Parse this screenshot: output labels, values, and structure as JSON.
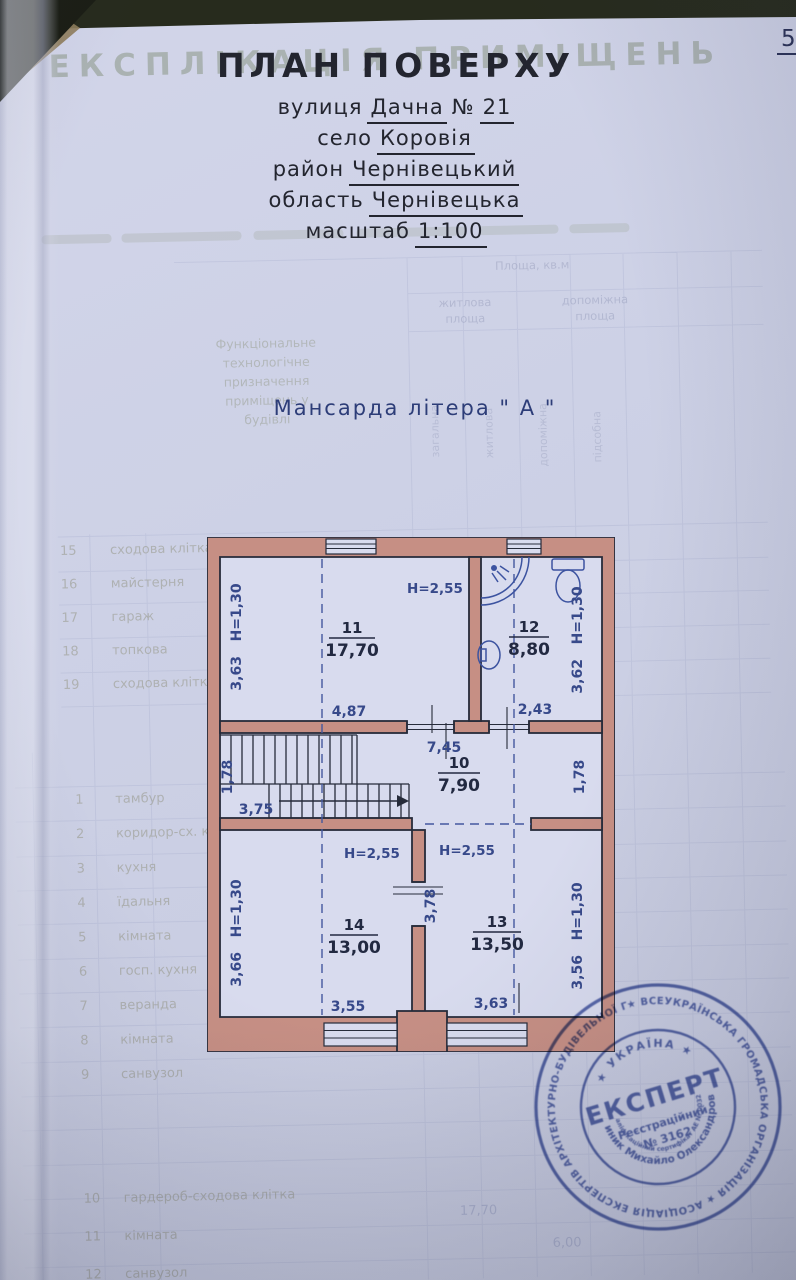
{
  "page": {
    "number": "5"
  },
  "header": {
    "ghost_title": "ЕКСПЛІКАЦІЯ ПРИМІЩЕНЬ",
    "title": "ПЛАН ПОВЕРХУ",
    "address": [
      {
        "label": "вулиця",
        "value": "Дачна",
        "mid": "№",
        "value2": "21"
      },
      {
        "label": "село",
        "value": "Коровія"
      },
      {
        "label": "район",
        "value": "Чернівецький"
      },
      {
        "label": "область",
        "value": "Чернівецька"
      },
      {
        "label": "масштаб",
        "value": "1:100"
      }
    ],
    "subtitle": "Мансарда літера \" А \""
  },
  "plan": {
    "rooms": {
      "r11": {
        "number": "11",
        "area": "17,70",
        "ceiling": "H=2,55",
        "side": "3,63   H=1,30",
        "width": "4,87"
      },
      "r12": {
        "number": "12",
        "area": "8,80",
        "side": "3,62   H=1,30",
        "width": "2,43"
      },
      "r10": {
        "number": "10",
        "area": "7,90",
        "width_top": "7,45",
        "left": "1,78",
        "right": "1,78",
        "stairs": "3,75"
      },
      "r14": {
        "number": "14",
        "area": "13,00",
        "ceiling": "H=2,55",
        "side": "3,66   H=1,30",
        "width": "3,55"
      },
      "r13": {
        "number": "13",
        "area": "13,50",
        "ceiling": "H=2,55",
        "partition": "3,78",
        "side": "3,56   H=1,30",
        "width": "3,63"
      }
    }
  },
  "stamp": {
    "outer_ring": "★ ВСЕУКРАЇНСЬКА ГРОМАДСЬКА ОРГАНІЗАЦІЯ ★ АСОЦІАЦІЯ ЕКСПЕРТІВ АРХІТЕКТУРНО-БУДІВЕЛЬНОЇ ГАЛУЗІ ★ АТЕСТАЦІЙНА КОМІСІЯ",
    "inner_top": "★ УКРАЇНА ★",
    "inner_name": "Гриник Михайло Олександрович",
    "inner_cert": "кваліфікаційний сертифікат АЕ № 003289",
    "name": "ЕКСПЕРТ",
    "reg_label": "Реєстраційний",
    "reg_number": "№ 3162"
  },
  "ghost": {
    "area_header": "Площа, кв.м",
    "col_headers": [
      [
        "житлова",
        "площа"
      ],
      [
        "допоміжна",
        "площа"
      ]
    ],
    "rot_labels": [
      "загальна",
      "житлова",
      "допоміжна",
      "підсобна"
    ],
    "function_lines": [
      "Функціональне",
      "технологічне",
      "призначення",
      "приміщень у",
      "будівлі"
    ],
    "mid_rows": [
      [
        "15",
        "сходова клітка"
      ],
      [
        "16",
        "майстерня"
      ],
      [
        "17",
        "гараж"
      ],
      [
        "18",
        "топкова"
      ],
      [
        "19",
        "сходова клітка"
      ]
    ],
    "rows": [
      [
        "1",
        "тамбур"
      ],
      [
        "2",
        "коридор-сх. клітка"
      ],
      [
        "3",
        "кухня"
      ],
      [
        "4",
        "їдальня"
      ],
      [
        "5",
        "кімната"
      ],
      [
        "6",
        "госп. кухня"
      ],
      [
        "7",
        "веранда"
      ],
      [
        "8",
        "кімната"
      ],
      [
        "9",
        "санвузол"
      ]
    ],
    "rows2": [
      [
        "10",
        "гардероб-сходова клітка"
      ],
      [
        "11",
        "кімната"
      ],
      [
        "12",
        "санвузол"
      ]
    ],
    "numbers": [
      {
        "t": "17,70",
        "x": 448,
        "y": 1216
      },
      {
        "t": "6,00",
        "x": 540,
        "y": 1250
      }
    ]
  }
}
